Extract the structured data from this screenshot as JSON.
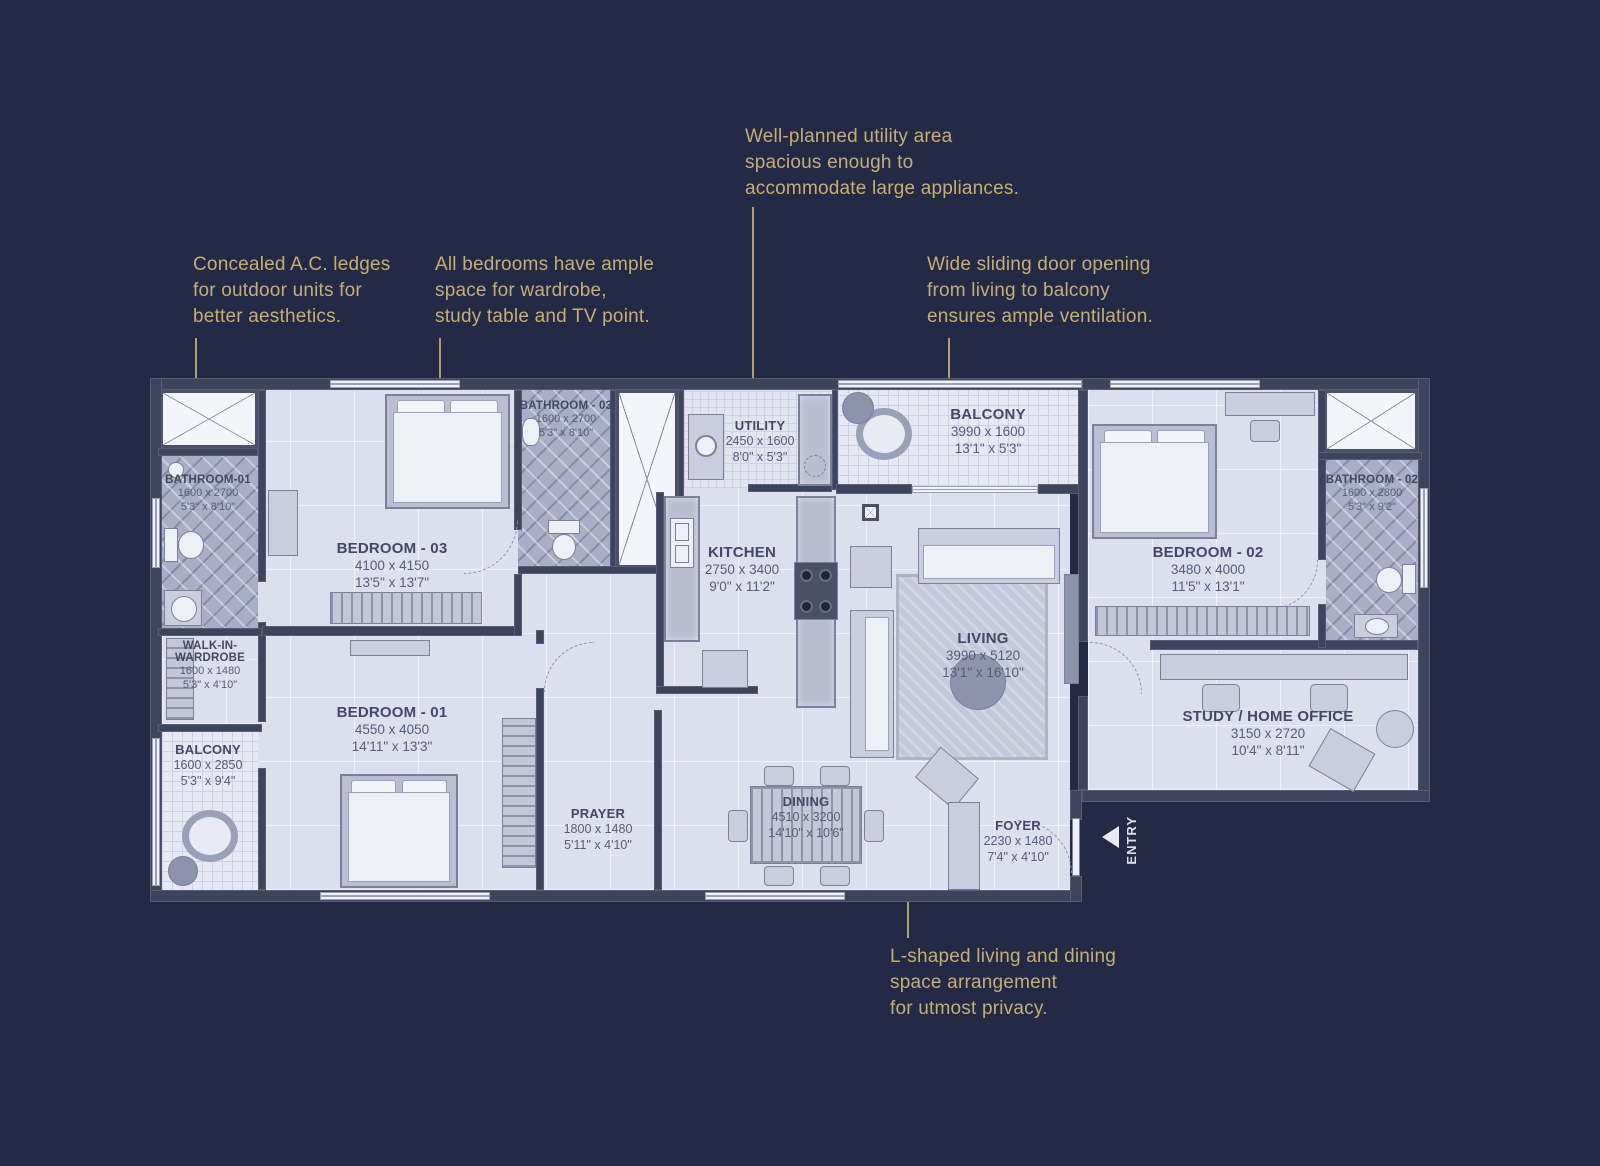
{
  "colors": {
    "background": "#242a45",
    "accent": "#c5ae76",
    "floor": "#dbdfee",
    "wall": "#3e445c"
  },
  "annotations": {
    "utility": {
      "lines": [
        "Well-planned utility area",
        "spacious enough to",
        "accommodate large appliances."
      ]
    },
    "ac": {
      "lines": [
        "Concealed A.C. ledges",
        "for outdoor units for",
        "better aesthetics."
      ]
    },
    "bedrooms": {
      "lines": [
        "All bedrooms have ample",
        "space for wardrobe,",
        "study table and TV point."
      ]
    },
    "sliding": {
      "lines": [
        "Wide sliding door opening",
        "from living to balcony",
        "ensures ample ventilation."
      ]
    },
    "lshape": {
      "lines": [
        "L-shaped living and dining",
        "space arrangement",
        "for utmost privacy."
      ]
    }
  },
  "rooms": {
    "bathroom01": {
      "name": "BATHROOM-01",
      "mm": "1600 x 2700",
      "ft": "5'3\" x 8'10\""
    },
    "wardrobe": {
      "name": "WALK-IN-WARDROBE",
      "mm": "1600 x 1480",
      "ft": "5'3\" x 4'10\""
    },
    "balconyLeft": {
      "name": "BALCONY",
      "mm": "1600 x 2850",
      "ft": "5'3\" x 9'4\""
    },
    "bedroom03": {
      "name": "BEDROOM - 03",
      "mm": "4100 x 4150",
      "ft": "13'5\" x 13'7\""
    },
    "bedroom01": {
      "name": "BEDROOM - 01",
      "mm": "4550 x 4050",
      "ft": "14'11\" x 13'3\""
    },
    "bathroom03": {
      "name": "BATHROOM - 03",
      "mm": "1600 x 2700",
      "ft": "5'3\" x 8'10\""
    },
    "utility": {
      "name": "UTILITY",
      "mm": "2450 x 1600",
      "ft": "8'0\" x 5'3\""
    },
    "kitchen": {
      "name": "KITCHEN",
      "mm": "2750 x 3400",
      "ft": "9'0\" x 11'2\""
    },
    "balconyTop": {
      "name": "BALCONY",
      "mm": "3990 x 1600",
      "ft": "13'1\" x 5'3\""
    },
    "living": {
      "name": "LIVING",
      "mm": "3990 x 5120",
      "ft": "13'1\" x 16'10\""
    },
    "bedroom02": {
      "name": "BEDROOM - 02",
      "mm": "3480 x 4000",
      "ft": "11'5\" x 13'1\""
    },
    "bathroom02": {
      "name": "BATHROOM - 02",
      "mm": "1600 x 2800",
      "ft": "5'3\" x 9'2\""
    },
    "study": {
      "name": "STUDY / HOME OFFICE",
      "mm": "3150 x 2720",
      "ft": "10'4\" x 8'11\""
    },
    "prayer": {
      "name": "PRAYER",
      "mm": "1800 x 1480",
      "ft": "5'11\" x 4'10\""
    },
    "dining": {
      "name": "DINING",
      "mm": "4510 x 3200",
      "ft": "14'10\" x 10'6\""
    },
    "foyer": {
      "name": "FOYER",
      "mm": "2230 x 1480",
      "ft": "7'4\" x 4'10\""
    }
  },
  "entry": {
    "label": "ENTRY"
  }
}
